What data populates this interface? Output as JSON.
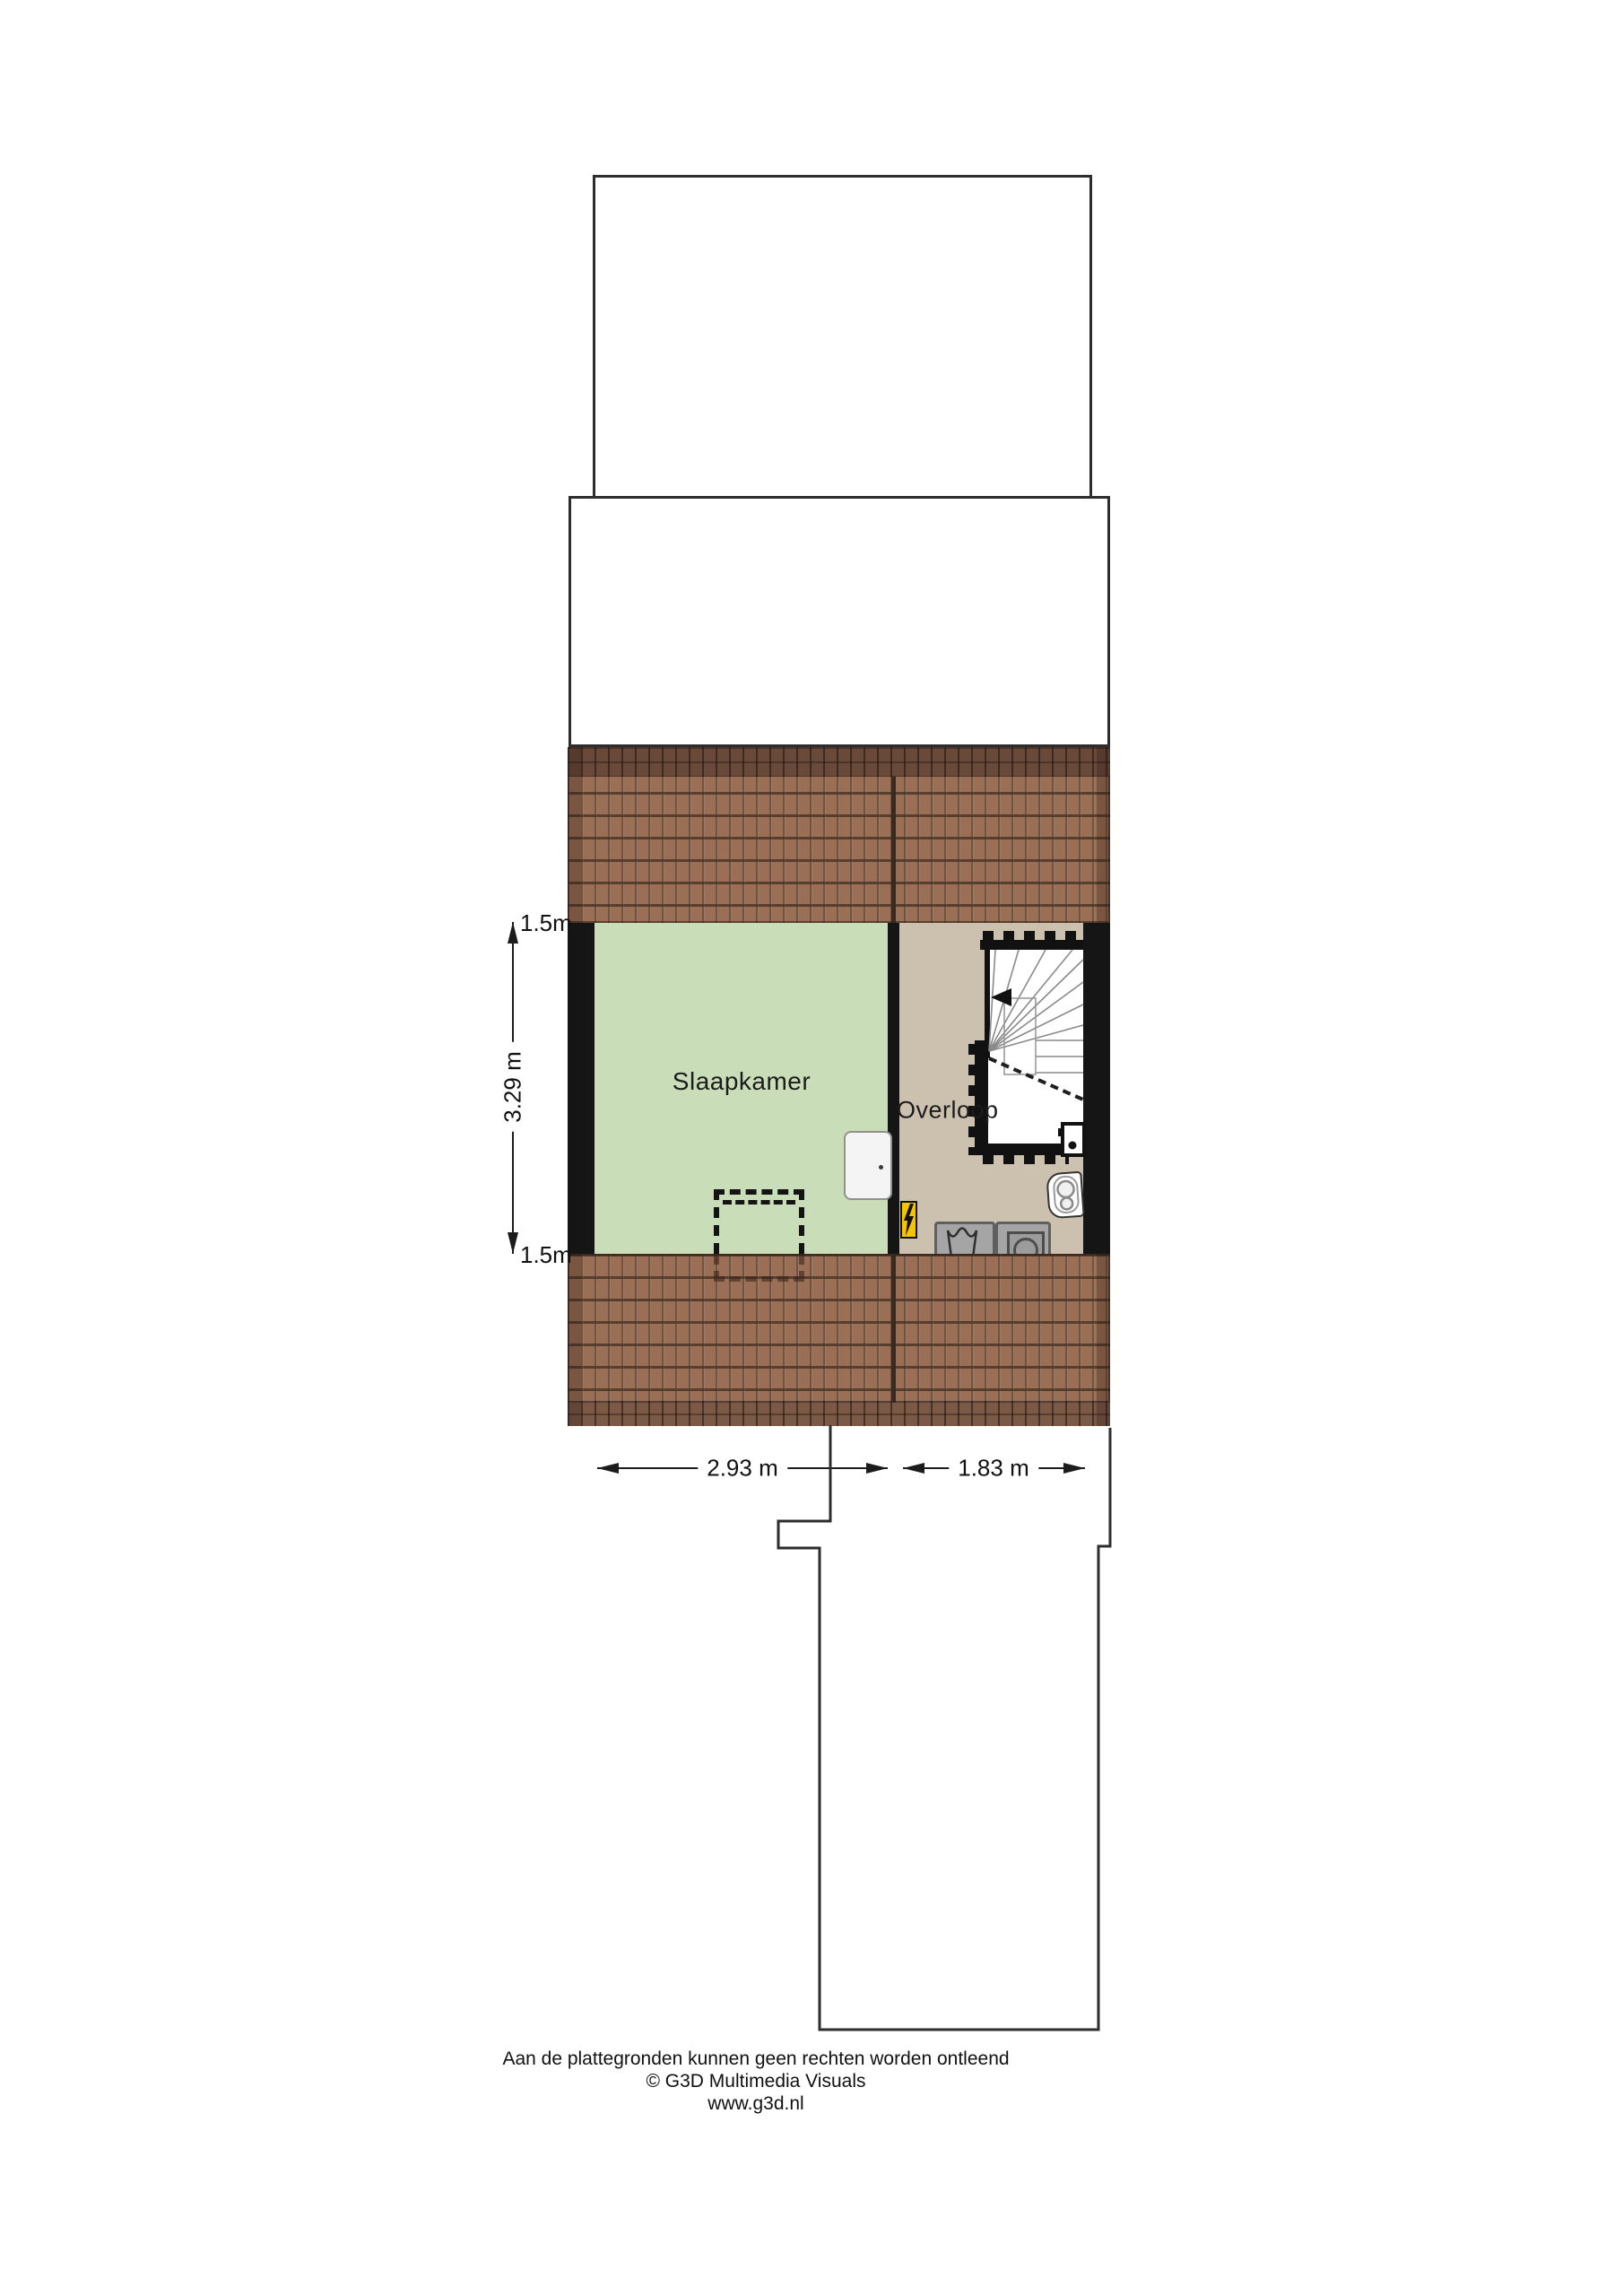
{
  "plan": {
    "floor_name": "attic floor plan",
    "rooms": [
      {
        "name": "Slaapkamer",
        "width": "2.93 m",
        "depth": "3.29 m",
        "floor_color": "#c9deb8"
      },
      {
        "name": "Overloop",
        "width": "1.83 m",
        "floor_color": "#ccc1af"
      }
    ]
  },
  "labels": {
    "bedroom": "Slaapkamer",
    "landing": "Overloop"
  },
  "dimensions": {
    "left_top": "1.5m",
    "left_height": "3.29 m",
    "left_bottom": "1.5m",
    "bedroom_width": "2.93 m",
    "landing_width": "1.83 m"
  },
  "footer": {
    "line1": "Aan de plattegronden kunnen geen rechten worden ontleend",
    "line2": "© G3D Multimedia Visuals",
    "line3": "www.g3d.nl"
  },
  "colors": {
    "bedroom_floor": "#c9deb8",
    "landing_floor": "#ccc1af",
    "roof_tile": "#9a6f56",
    "roof_ridge": "#69493a",
    "roof_eaves": "#7b5947",
    "wall": "#151515",
    "electrical_box": "#f2c500",
    "appliance_gray": "#a5a5a5",
    "outline": "#2d2d2d"
  },
  "icons": [
    "stair-direction-arrow-icon",
    "lightning-bolt-icon",
    "laundry-basin-icon",
    "washing-machine-icon",
    "boiler-icon",
    "door-icon",
    "toilet-icon"
  ]
}
